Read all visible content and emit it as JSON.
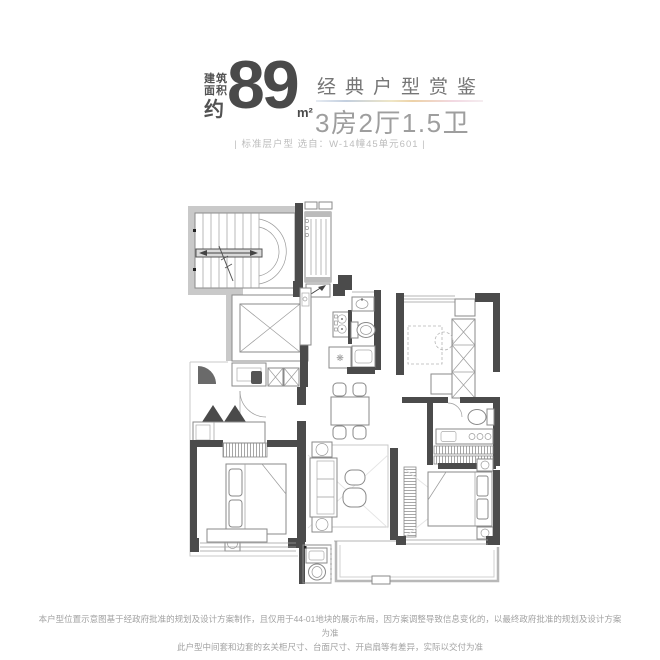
{
  "header": {
    "area_label_top": "建筑",
    "area_label_bottom": "面积",
    "area_approx": "约",
    "area_value": "89",
    "area_unit": "m²",
    "title": "经典户型赏鉴",
    "subtitle": "3房2厅1.5卫",
    "selection_note": "| 标准层户型  选自：W-14幢45单元601 |"
  },
  "floorplan": {
    "fridge_symbol": "❋"
  },
  "footer": {
    "line1": "本户型位置示意图基于经政府批准的规划及设计方案制作，且仅用于44-01地块的展示布局，因方案调整导致信息变化的，以最终政府批准的规划及设计方案为准",
    "line2": "此户型中间套和边套的玄关柜尺寸、台面尺寸、开启扇等有差异，实际以交付为准"
  },
  "colors": {
    "headline_dark": "#4a4a4a",
    "title_gray": "#767676",
    "subtitle_gray": "#9e9e9e",
    "note_gray": "#bdbdbd",
    "wall": "#4b4b4b",
    "light_wall": "#c9c9c9",
    "drawing_line": "#8a8a8a",
    "underline_gradient_left": "#c3cfdf",
    "underline_gradient_mid": "#edd2a8",
    "underline_gradient_right": "#f2d8e2"
  }
}
